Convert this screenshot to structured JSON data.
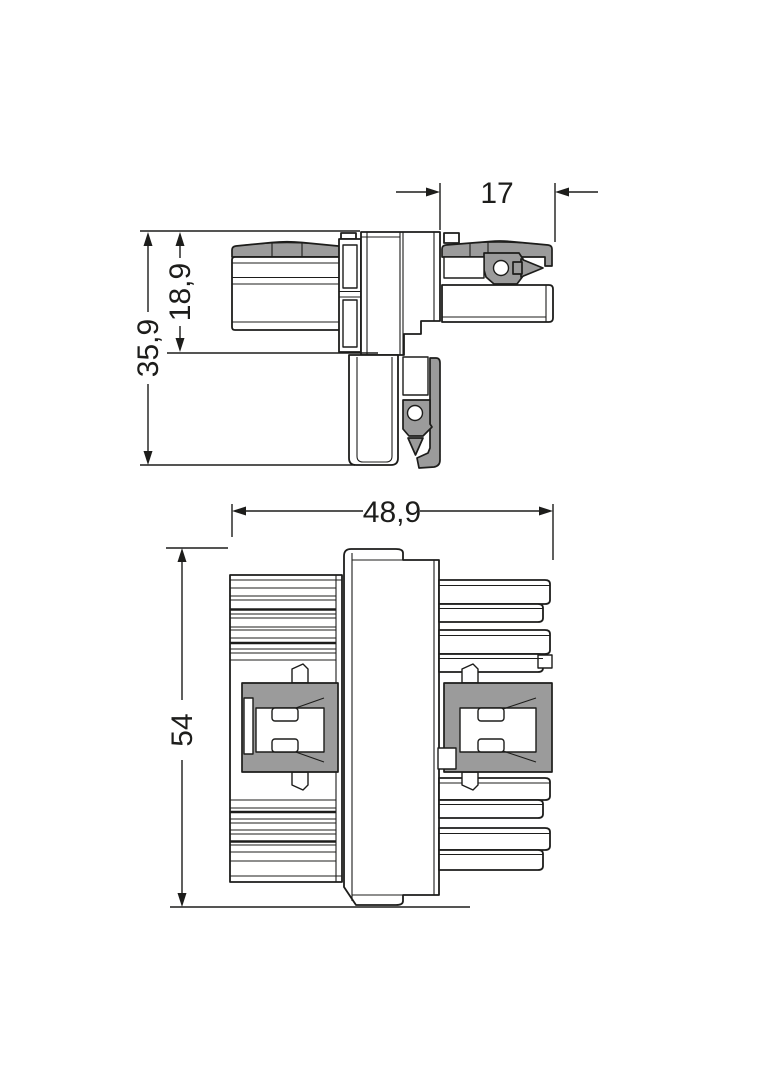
{
  "drawing": {
    "side_view": {
      "dimensions": {
        "plug_protrusion_mm": "17",
        "housing_height_mm": "18,9",
        "total_height_mm": "35,9"
      }
    },
    "front_view": {
      "dimensions": {
        "total_width_mm": "48,9",
        "total_height_mm": "54"
      }
    },
    "colors": {
      "line": "#1d1d1b",
      "shaded_part": "#9b9b9b",
      "background": "#ffffff"
    }
  }
}
